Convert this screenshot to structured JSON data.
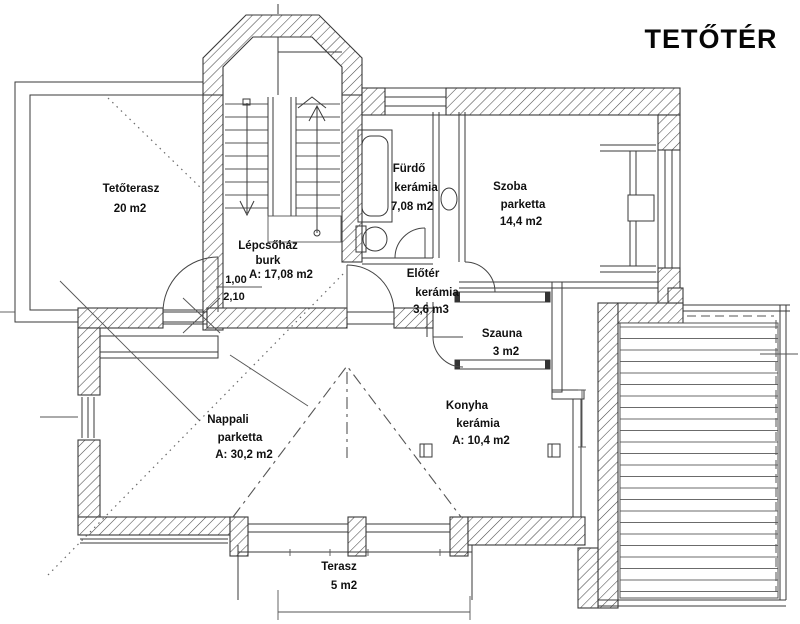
{
  "title": "TETŐTÉR",
  "plan": {
    "rooms": {
      "tetoterasz": {
        "name": "Tetőterasz",
        "area": "20 m2"
      },
      "lepcsohaz": {
        "name": "Lépcsőház",
        "material": "burk",
        "area": "A: 17,08 m2"
      },
      "furdo": {
        "name": "Fürdő",
        "material": "kerámia",
        "area": "7,08 m2"
      },
      "szoba": {
        "name": "Szoba",
        "material": "parketta",
        "area": "14,4 m2"
      },
      "eloter": {
        "name": "Előtér",
        "material": "kerámia",
        "area": "3,6 m3"
      },
      "szauna": {
        "name": "Szauna",
        "area": "3 m2"
      },
      "nappali": {
        "name": "Nappali",
        "material": "parketta",
        "area": "A: 30,2 m2"
      },
      "konyha": {
        "name": "Konyha",
        "material": "kerámia",
        "area": "A: 10,4 m2"
      },
      "terasz": {
        "name": "Terasz",
        "area": "5 m2"
      }
    },
    "door_dimension": {
      "width": "1,00",
      "height": "2,10"
    }
  }
}
